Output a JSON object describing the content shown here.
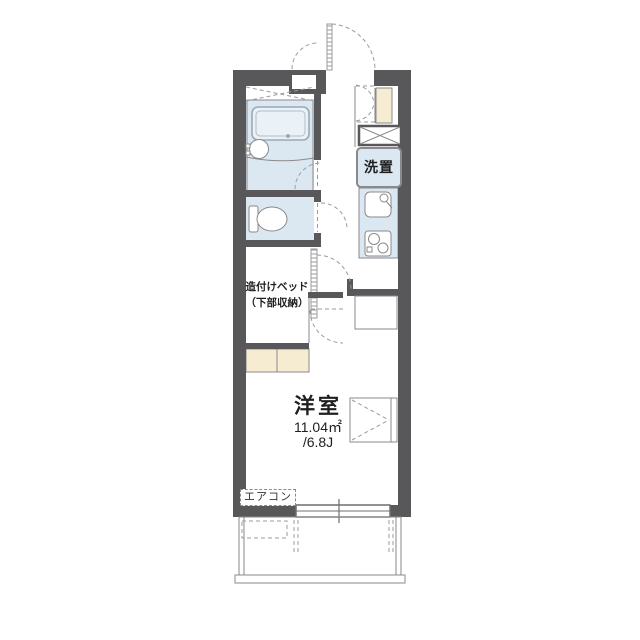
{
  "plan": {
    "type": "apartment-floor-plan",
    "labels": {
      "washer": "洗置",
      "bed_line1": "造付けベッド",
      "bed_line2": "（下部収納）",
      "aircon": "エアコン"
    },
    "room": {
      "name": "洋室",
      "area_sqm": "11.04㎡",
      "area_jo": "/6.8J"
    },
    "fixtures": [
      "entrance-door",
      "storage-niche",
      "shoe-cabinet",
      "washing-machine-space",
      "kitchen-sink",
      "gas-stove",
      "bathtub",
      "washbasin",
      "toilet",
      "built-in-bed",
      "bed-steps",
      "refrigerator-space",
      "room-door",
      "casement-window",
      "sliding-window",
      "air-conditioner",
      "balcony",
      "ac-outdoor-unit"
    ],
    "colors": {
      "wall": "#58585a",
      "water_area": "#dce8f1",
      "entrance_floor": "#f6ecd2",
      "line": "#8a8a8d",
      "dash": "#9b9b9e",
      "text": "#1f1f1f"
    }
  }
}
